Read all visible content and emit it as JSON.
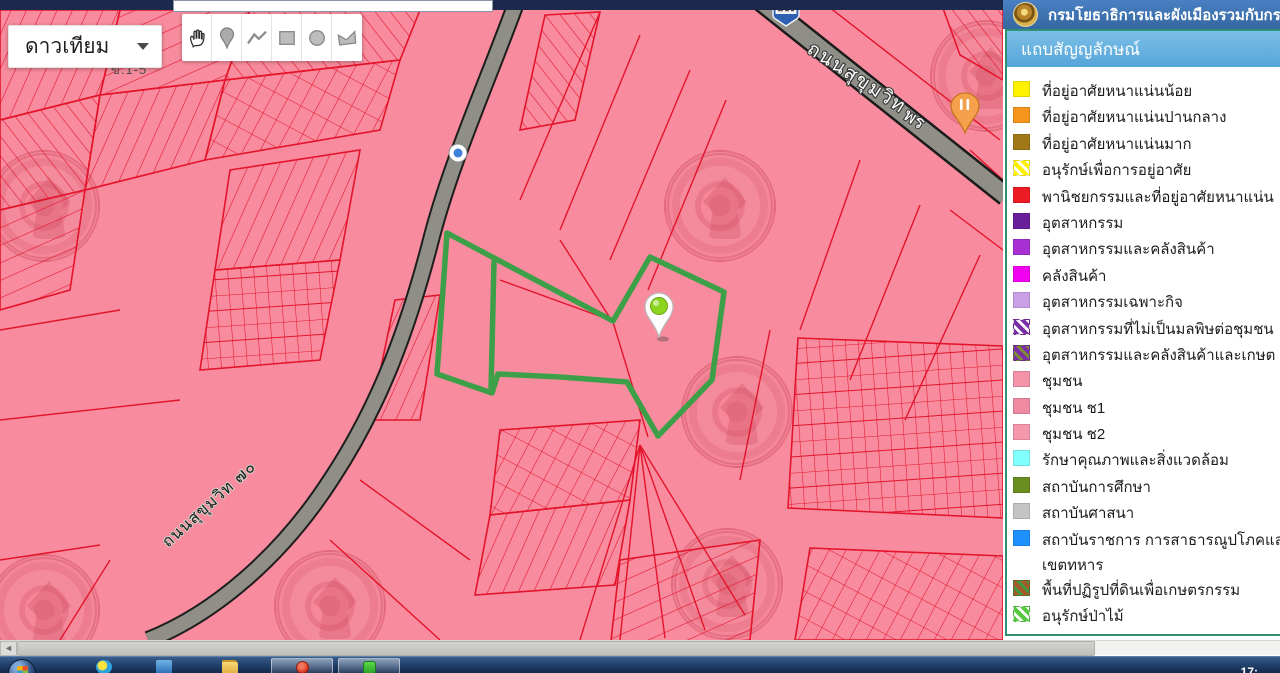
{
  "header": {
    "title": "กรมโยธาธิการและผังเมืองรวมกับกร",
    "emblem_icon": "department-gold-seal"
  },
  "map": {
    "basemap_dropdown": {
      "value": "ดาวเทียม"
    },
    "toolbar_tools": [
      "pan-hand",
      "place-marker",
      "draw-polyline",
      "draw-rectangle",
      "draw-circle",
      "draw-polygon"
    ],
    "labels": {
      "road_main": "ถนนสุขุมวิท",
      "road_secondary": "ถนนสุขุมวิท ๗๐",
      "zone_label": "ข.1-5",
      "poi_partial": "พร"
    },
    "markers": [
      "green-location-pin",
      "orange-food-pin",
      "blue-route-shield",
      "blue-poi-dot"
    ],
    "colors": {
      "map_pink": "#F88C9E",
      "parcel_red": "#E3142C",
      "road_gray": "#8F8F88",
      "selection_green": "#3DA048"
    }
  },
  "legend": {
    "title": "แถบสัญญลักษณ์",
    "items": [
      {
        "label": "ที่อยู่อาศัยหนาแน่นน้อย",
        "color": "#FFF200",
        "pattern": "solid"
      },
      {
        "label": "ที่อยู่อาศัยหนาแน่นปานกลาง",
        "color": "#F7941E",
        "pattern": "solid"
      },
      {
        "label": "ที่อยู่อาศัยหนาแน่นมาก",
        "color": "#A07818",
        "pattern": "solid"
      },
      {
        "label": "อนุรักษ์เพื่อการอยู่อาศัย",
        "color": "#FFF200",
        "color2": "#FFFFFF",
        "pattern": "stripes"
      },
      {
        "label": "พานิชยกรรมและที่อยู่อาศัยหนาแน่น",
        "color": "#ED1C24",
        "pattern": "solid"
      },
      {
        "label": "อุตสาหกรรม",
        "color": "#6A1F9A",
        "pattern": "solid"
      },
      {
        "label": "อุตสาหกรรมและคลังสินค้า",
        "color": "#A82FD4",
        "pattern": "solid"
      },
      {
        "label": "คลังสินค้า",
        "color": "#F200F2",
        "pattern": "solid"
      },
      {
        "label": "อุตสาหกรรมเฉพาะกิจ",
        "color": "#C9A0E8",
        "pattern": "solid"
      },
      {
        "label": "อุตสาหกรรมที่ไม่เป็นมลพิษต่อชุมชน",
        "color": "#7B2FA6",
        "color2": "#FFFFFF",
        "pattern": "stripes"
      },
      {
        "label": "อุตสาหกรรมและคลังสินค้าและเกษต",
        "color": "#7B2FA6",
        "color2": "#7E8F33",
        "pattern": "stripes"
      },
      {
        "label": "ชุมชน",
        "color": "#F493A8",
        "pattern": "solid"
      },
      {
        "label": "ชุมชน ช1",
        "color": "#EE8AA2",
        "pattern": "solid"
      },
      {
        "label": "ชุมชน ช2",
        "color": "#F598AC",
        "pattern": "solid"
      },
      {
        "label": "รักษาคุณภาพและสิ่งแวดล้อม",
        "color": "#80FFFF",
        "pattern": "solid"
      },
      {
        "label": "สถาบันการศึกษา",
        "color": "#6B8E23",
        "pattern": "solid"
      },
      {
        "label": "สถาบันศาสนา",
        "color": "#C4C4C4",
        "pattern": "solid"
      },
      {
        "label": "สถาบันราชการ การสาธารณูปโภคแล",
        "label2": "เขตทหาร",
        "color": "#1E90FF",
        "pattern": "solid"
      },
      {
        "label": "พื้นที่ปฏิรูปที่ดินเพื่อเกษตรกรรม",
        "color": "#A65A28",
        "color2": "#3C9C44",
        "pattern": "stripes"
      },
      {
        "label": "อนุรักษ์ป่าไม้",
        "color": "#55C840",
        "color2": "#FFFFFF",
        "pattern": "stripes"
      }
    ]
  },
  "taskbar": {
    "icons": [
      "start-orb",
      "ie-browser-icon",
      "blue-app-icon",
      "folder-icon",
      "red-app-window-button",
      "green-app-window-button"
    ],
    "clock": "17:"
  }
}
